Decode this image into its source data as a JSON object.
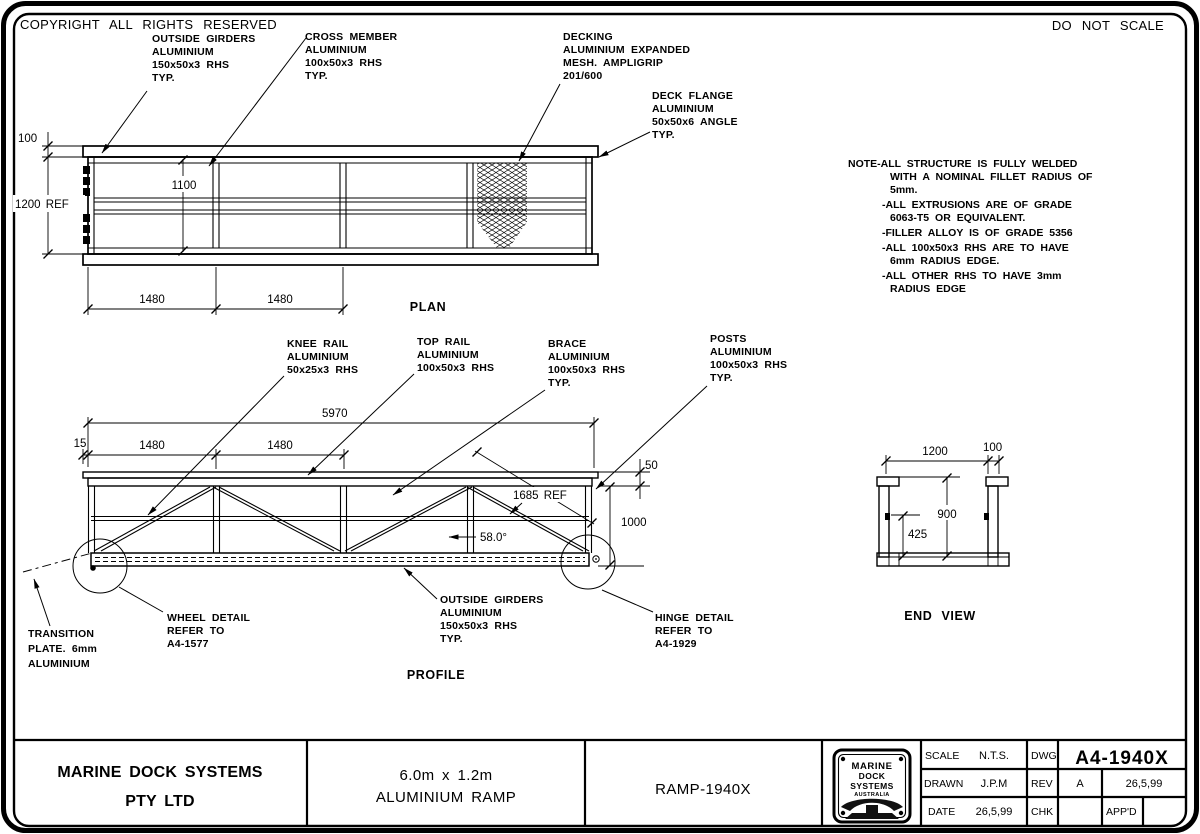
{
  "sheet": {
    "copyright": "COPYRIGHT ALL RIGHTS RESERVED",
    "do_not_scale": "DO NOT SCALE"
  },
  "notes": [
    "NOTE-ALL STRUCTURE IS FULLY WELDED",
    "WITH A NOMINAL FILLET RADIUS OF",
    "5mm.",
    "-ALL EXTRUSIONS ARE OF GRADE",
    "6063-T5 OR EQUIVALENT.",
    "-FILLER ALLOY IS OF GRADE 5356",
    "-ALL 100x50x3 RHS ARE TO HAVE",
    "6mm RADIUS EDGE.",
    "-ALL OTHER RHS TO HAVE 3mm",
    "RADIUS EDGE"
  ],
  "plan": {
    "title": "PLAN",
    "labels": {
      "outside_girders": [
        "OUTSIDE GIRDERS",
        "ALUMINIUM",
        "150x50x3 RHS",
        "TYP."
      ],
      "cross_member": [
        "CROSS MEMBER",
        "ALUMINIUM",
        "100x50x3 RHS",
        "TYP."
      ],
      "decking": [
        "DECKING",
        "ALUMINIUM EXPANDED",
        "MESH. AMPLIGRIP",
        "201/600"
      ],
      "deck_flange": [
        "DECK FLANGE",
        "ALUMINIUM",
        "50x50x6 ANGLE",
        "TYP."
      ]
    },
    "dims": {
      "flange": "100",
      "width_ref": "1200 REF",
      "inner_width": "1100",
      "bay1": "1480",
      "bay2": "1480"
    }
  },
  "profile": {
    "title": "PROFILE",
    "labels": {
      "knee_rail": [
        "KNEE RAIL",
        "ALUMINIUM",
        "50x25x3 RHS"
      ],
      "top_rail": [
        "TOP RAIL",
        "ALUMINIUM",
        "100x50x3 RHS"
      ],
      "brace": [
        "BRACE",
        "ALUMINIUM",
        "100x50x3 RHS",
        "TYP."
      ],
      "posts": [
        "POSTS",
        "ALUMINIUM",
        "100x50x3 RHS",
        "TYP."
      ],
      "outside_girders": [
        "OUTSIDE GIRDERS",
        "ALUMINIUM",
        "150x50x3 RHS",
        "TYP."
      ],
      "wheel_detail": [
        "WHEEL DETAIL",
        "REFER TO",
        "A4-1577"
      ],
      "hinge_detail": [
        "HINGE DETAIL",
        "REFER TO",
        "A4-1929"
      ],
      "transition_plate": [
        "TRANSITION",
        "PLATE. 6mm",
        "ALUMINIUM"
      ]
    },
    "dims": {
      "overall": "5970",
      "left_offset": "15",
      "bay1": "1480",
      "bay2": "1480",
      "rail_depth": "50",
      "height": "1000",
      "brace_length": "1685 REF",
      "brace_angle": "58.0°"
    }
  },
  "end_view": {
    "title": "END VIEW",
    "dims": {
      "width": "1200",
      "post_width": "100",
      "post_height": "900",
      "lug_height": "425"
    }
  },
  "title_block": {
    "company_line1": "MARINE DOCK SYSTEMS",
    "company_line2": "PTY LTD",
    "description_line1": "6.0m x 1.2m",
    "description_line2": "ALUMINIUM RAMP",
    "product_code": "RAMP-1940X",
    "logo": {
      "line1": "MARINE",
      "line2": "DOCK",
      "line3": "SYSTEMS",
      "line4": "AUSTRALIA"
    },
    "fields": {
      "scale_label": "SCALE",
      "scale_value": "N.T.S.",
      "drawn_label": "DRAWN",
      "drawn_value": "J.P.M",
      "date_label": "DATE",
      "date_value": "26,5,99",
      "dwg_label": "DWG",
      "dwg_value": "A4-1940X",
      "rev_label": "REV",
      "rev_value": "A",
      "rev_date": "26,5,99",
      "chk_label": "CHK",
      "chk_value": "",
      "appd_label": "APP'D",
      "appd_value": ""
    }
  }
}
